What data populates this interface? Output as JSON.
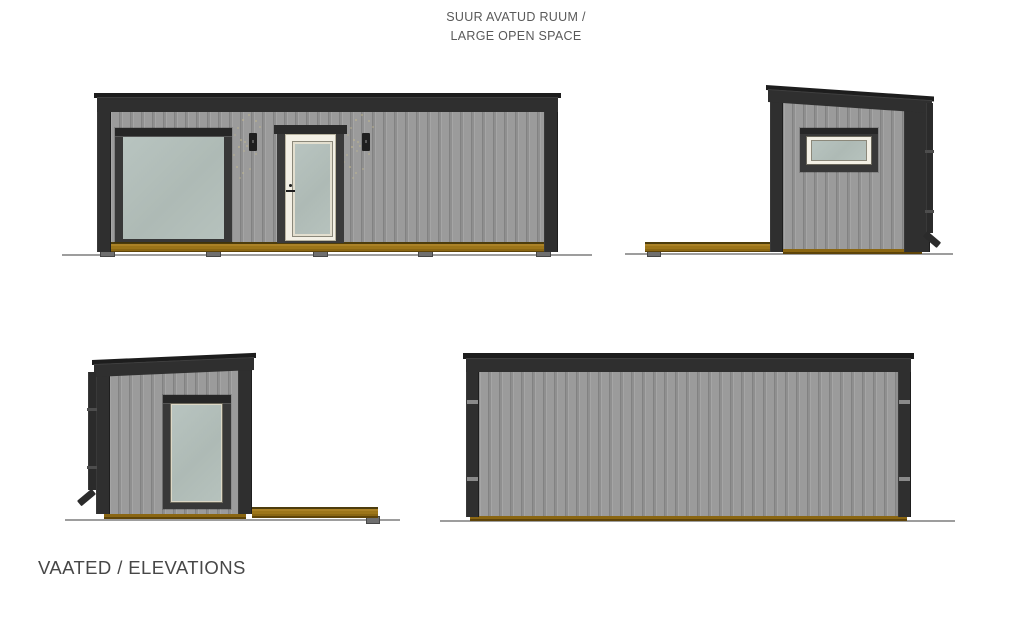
{
  "header": {
    "project_label_line1": "SUUR AVATUD RUUM /",
    "project_label_line2": "LARGE OPEN SPACE"
  },
  "footer": {
    "sheet_label": "VAATED / ELEVATIONS"
  },
  "views": [
    {
      "id": "front-elevation",
      "position": "top-left"
    },
    {
      "id": "right-side-elevation",
      "position": "top-right"
    },
    {
      "id": "left-side-elevation",
      "position": "bottom-left"
    },
    {
      "id": "back-elevation",
      "position": "bottom-right"
    }
  ],
  "colors": {
    "background": "#ffffff",
    "wall_gray": "#9b9b9b",
    "trim_dark": "#2f2f2f",
    "roof_cap": "#1d1d1d",
    "glass_sage": "#b4c0bb",
    "door_cream": "#f3f0e5",
    "deck_amber": "#9c7519",
    "deck_edge": "#5e4409",
    "ground_gray": "#9d9d9d",
    "label_gray": "#595959",
    "footer_gray": "#474747",
    "lamp_black": "#1f1f1f"
  }
}
